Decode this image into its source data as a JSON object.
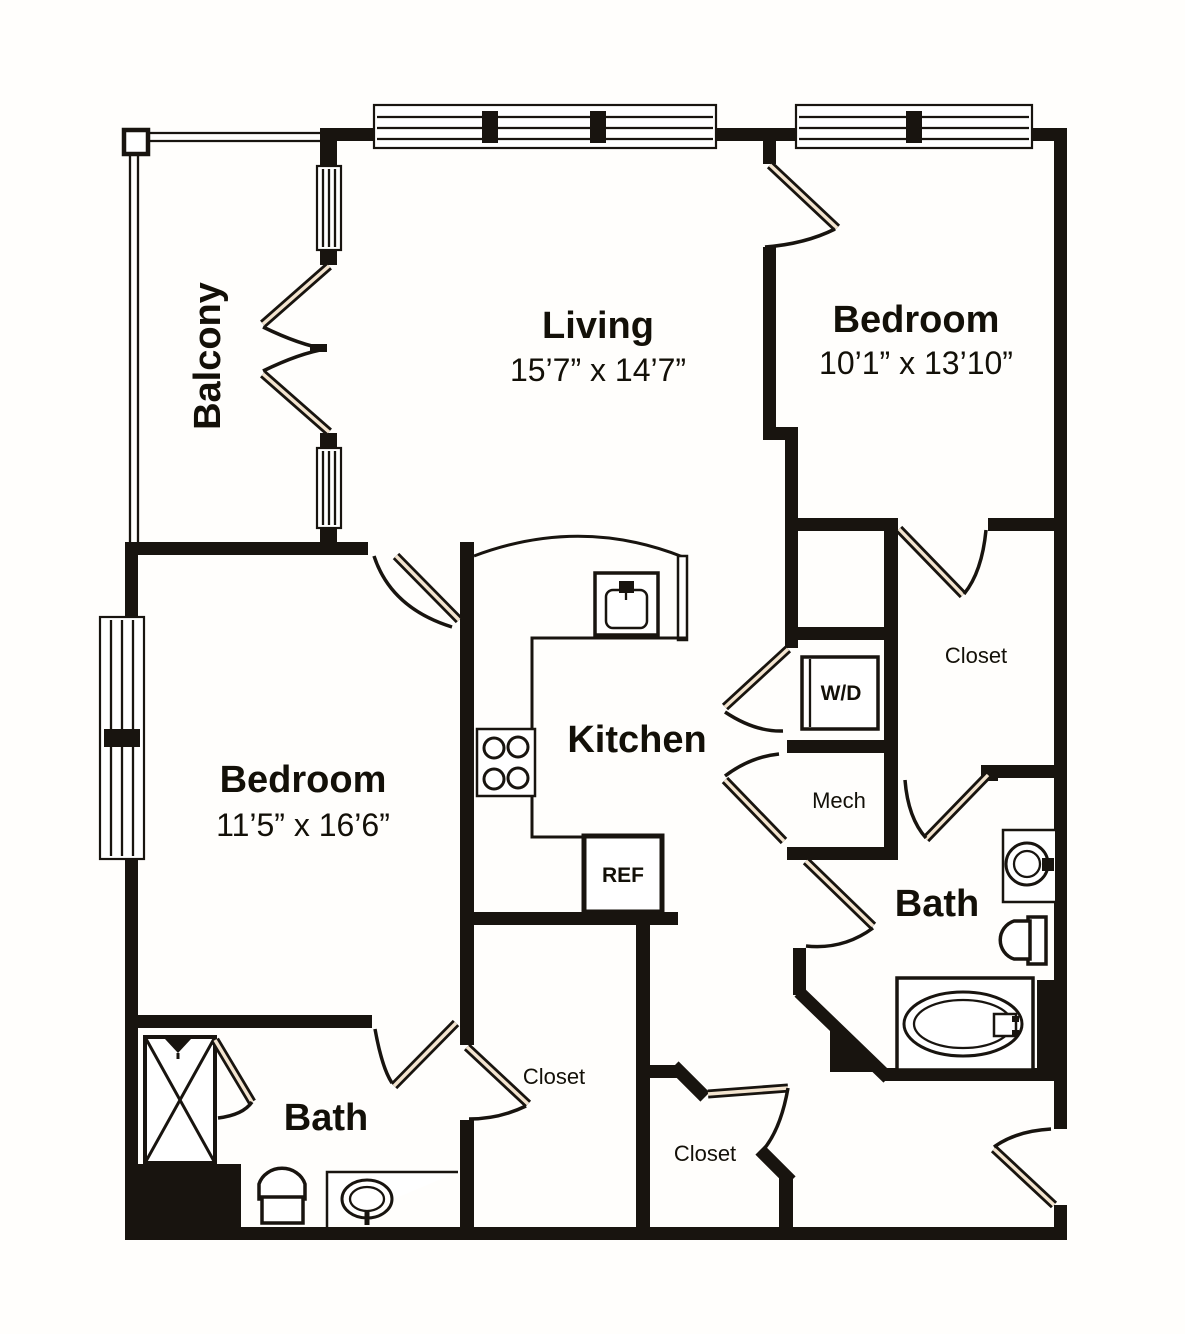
{
  "title": "Two bedroom two bath apartment floor plan",
  "colors": {
    "wall": "#18140f",
    "background": "#ffffff",
    "door_accent": "#f3e4cf",
    "text": "#131008"
  },
  "labels": {
    "balcony": "Balcony",
    "living": "Living",
    "living_dims": "15’7” x 14’7”",
    "bedroom_right": "Bedroom",
    "bedroom_right_dims": "10’1” x 13’10”",
    "bedroom_left": "Bedroom",
    "bedroom_left_dims": "11’5” x 16’6”",
    "kitchen": "Kitchen",
    "bath_right": "Bath",
    "bath_left": "Bath",
    "closet_bedroom_right": "Closet",
    "closet_hall_left": "Closet",
    "closet_hall_bottom": "Closet",
    "washer_dryer": "W/D",
    "mech": "Mech",
    "refrigerator": "REF"
  },
  "icons": [
    "kitchen-sink-icon",
    "cooktop-icon",
    "refrigerator-icon",
    "washer-dryer-icon",
    "toilet-icon",
    "vanity-sink-icon",
    "bathtub-icon",
    "shower-icon",
    "door-swing-icon",
    "window-icon",
    "balcony-railing-icon"
  ]
}
